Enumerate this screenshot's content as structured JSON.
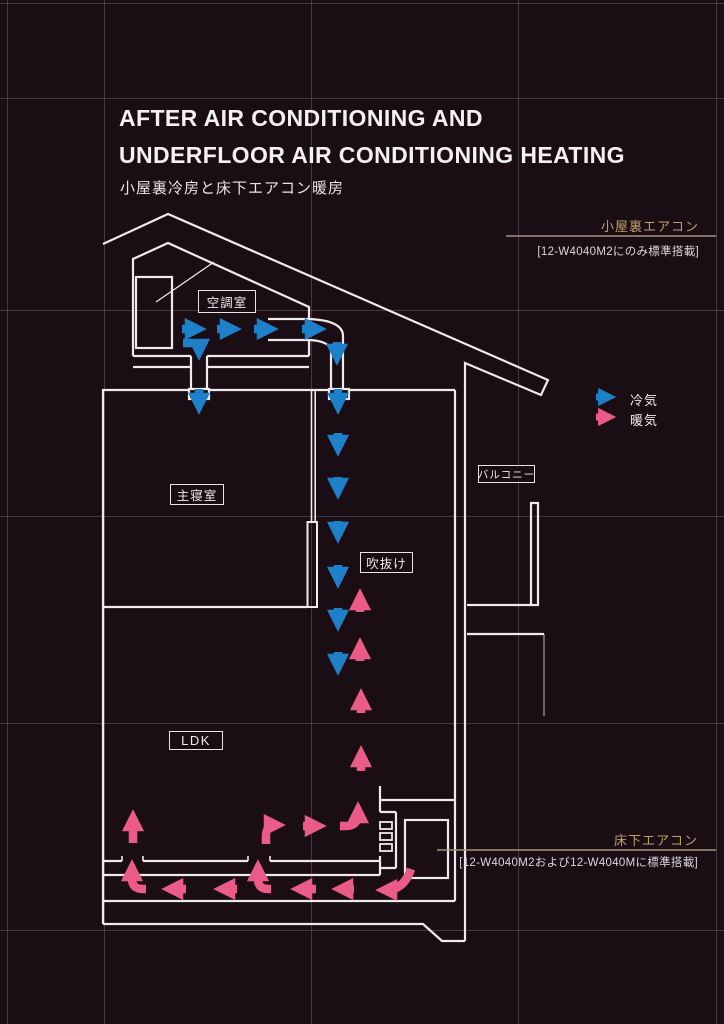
{
  "header": {
    "title_line1": "AFTER AIR CONDITIONING AND",
    "title_line2": "UNDERFLOOR AIR CONDITIONING HEATING",
    "subtitle": "小屋裏冷房と床下エアコン暖房"
  },
  "legend": {
    "cold": {
      "label": "冷気",
      "color": "#1d80c8"
    },
    "warm": {
      "label": "暖気",
      "color": "#ea5c87"
    }
  },
  "rooms": {
    "ac_room": "空調室",
    "master_bedroom": "主寝室",
    "atrium": "吹抜け",
    "balcony": "バルコニー",
    "ldk": "LDK"
  },
  "callouts": {
    "attic_ac": {
      "label": "小屋裏エアコン",
      "spec": "[12-W4040M2にのみ標準搭載]"
    },
    "underfloor_ac": {
      "label": "床下エアコン",
      "spec": "[12-W4040M2および12-W4040Mに標準搭載]"
    }
  },
  "colors": {
    "background": "#1a0d13",
    "linework": "#efeaed",
    "grid": "#a79ca5",
    "callout_accent": "#c29f6c",
    "cold_air": "#1d80c8",
    "warm_air": "#ea5c87"
  }
}
